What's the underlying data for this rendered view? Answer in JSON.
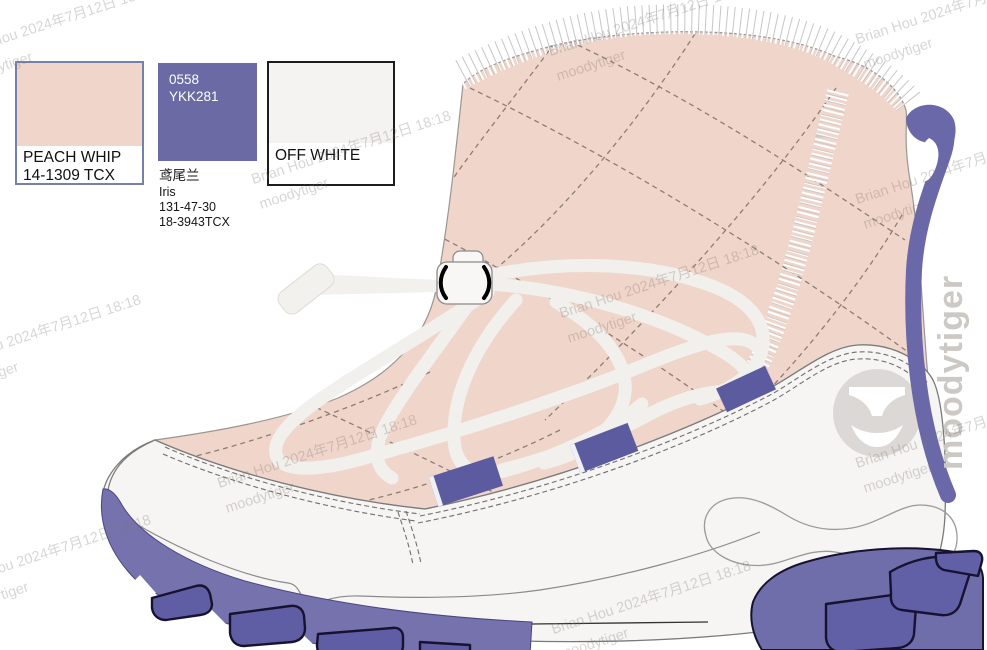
{
  "swatches": [
    {
      "name": "PEACH WHIP",
      "code": "14-1309 TCX",
      "fill": "#f0d5cb",
      "border": "#7580ab"
    },
    {
      "zip_no": "0558",
      "zip_code": "YKK281",
      "cn_name": "鸢尾兰",
      "en_name": "Iris",
      "code_a": "131-47-30",
      "code_b": "18-3943TCX",
      "fill": "#6b6aa5"
    },
    {
      "name": "OFF WHITE",
      "fill": "#f4f3f1",
      "border": "#1c1c1c"
    }
  ],
  "watermark": {
    "line1": "Brian Hou 2024年7月12日 18:18",
    "line2": "moodytiger"
  },
  "brand": {
    "side_text": "moodytiger",
    "logo_icon": "moodytiger-tiger-face"
  },
  "palette": {
    "peach": "#f0d5cb",
    "iris_purple": "#6b6aa5",
    "off_white": "#f4f3f1",
    "sole_purple": "#7572ae",
    "lug_purple": "#5f5da3",
    "heel_tab_purple": "#6a68a8",
    "outline_gray": "#7a7a7a",
    "logo_gray": "#dcd8d5",
    "lace_white": "#f2f0ec"
  }
}
